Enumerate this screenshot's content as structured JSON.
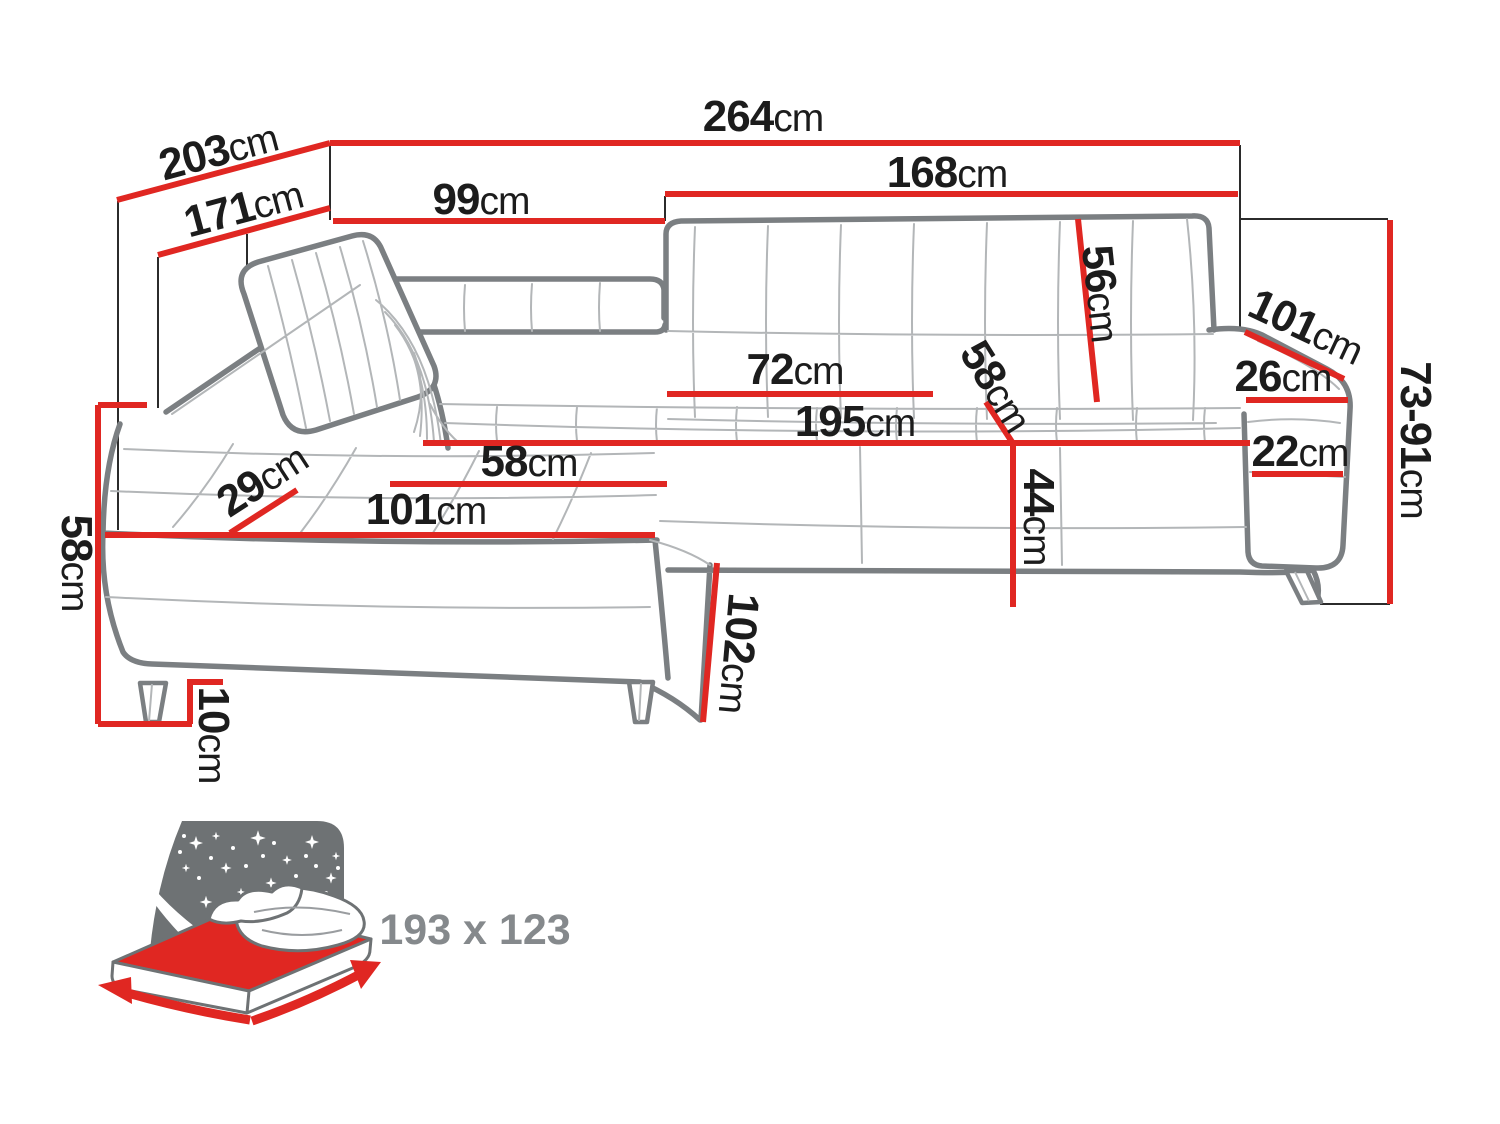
{
  "unit_default": "cm",
  "dims": {
    "total_width": {
      "v": "264",
      "u": "cm"
    },
    "total_depth": {
      "v": "203",
      "u": "cm"
    },
    "inner_depth": {
      "v": "171",
      "u": "cm"
    },
    "corner_back_width": {
      "v": "99",
      "u": "cm"
    },
    "right_back_width": {
      "v": "168",
      "u": "cm"
    },
    "backrest_height": {
      "v": "56",
      "u": "cm"
    },
    "armrest_length": {
      "v": "101",
      "u": "cm"
    },
    "armrest_top_width": {
      "v": "26",
      "u": "cm"
    },
    "total_height_range": {
      "v": "73-91",
      "u": "cm"
    },
    "seat_cushion_width": {
      "v": "72",
      "u": "cm"
    },
    "seat_depth_right": {
      "v": "58",
      "u": "cm"
    },
    "seat_front_width": {
      "v": "195",
      "u": "cm"
    },
    "armrest_side_height": {
      "v": "22",
      "u": "cm"
    },
    "seat_height_front": {
      "v": "44",
      "u": "cm"
    },
    "headrest_depth": {
      "v": "29",
      "u": "cm"
    },
    "chaise_seat_depth": {
      "v": "58",
      "u": "cm"
    },
    "chaise_seat_width": {
      "v": "101",
      "u": "cm"
    },
    "chaise_side_height": {
      "v": "58",
      "u": "cm"
    },
    "leg_height": {
      "v": "10",
      "u": "cm"
    },
    "chaise_length": {
      "v": "102",
      "u": "cm"
    }
  },
  "bed_function": {
    "size_label": "193 x 123"
  },
  "colors": {
    "dimension_red": "#e02722",
    "outline_gray": "#7b7f82",
    "detail_gray": "#b3b6b8",
    "text_black": "#1c1c1c",
    "icon_gray": "#6e7274",
    "bed_label_gray": "#85898c"
  }
}
